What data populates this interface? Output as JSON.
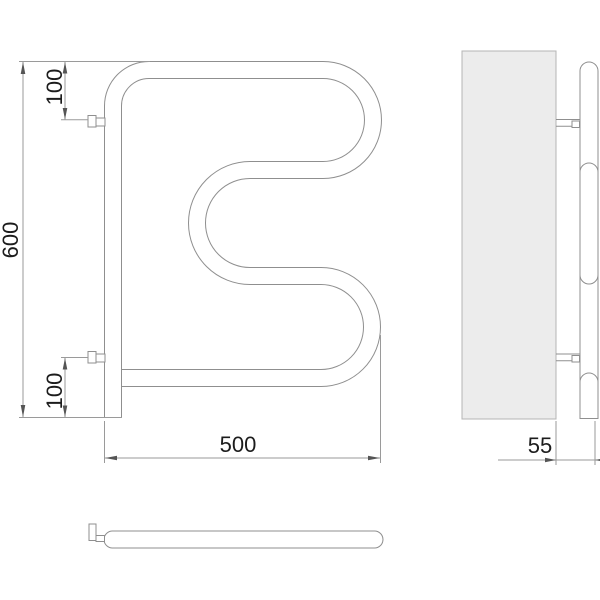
{
  "drawing": {
    "type": "technical-drawing",
    "subject": "serpentine-towel-rail",
    "views": {
      "front": "front-view",
      "side": "side-view",
      "bottom": "bottom-view"
    },
    "dimensions": {
      "height": "600",
      "top_bracket_offset": "100",
      "bottom_bracket_offset": "100",
      "width": "500",
      "wall_distance": "55"
    },
    "colors": {
      "background": "#ffffff",
      "outline": "#8f8f8f",
      "dimension_line": "#9a9a9a",
      "arrow": "#555555",
      "text": "#1c1c1c",
      "wall_fill": "#ececec",
      "wall_stroke": "#b5b5b5"
    }
  }
}
